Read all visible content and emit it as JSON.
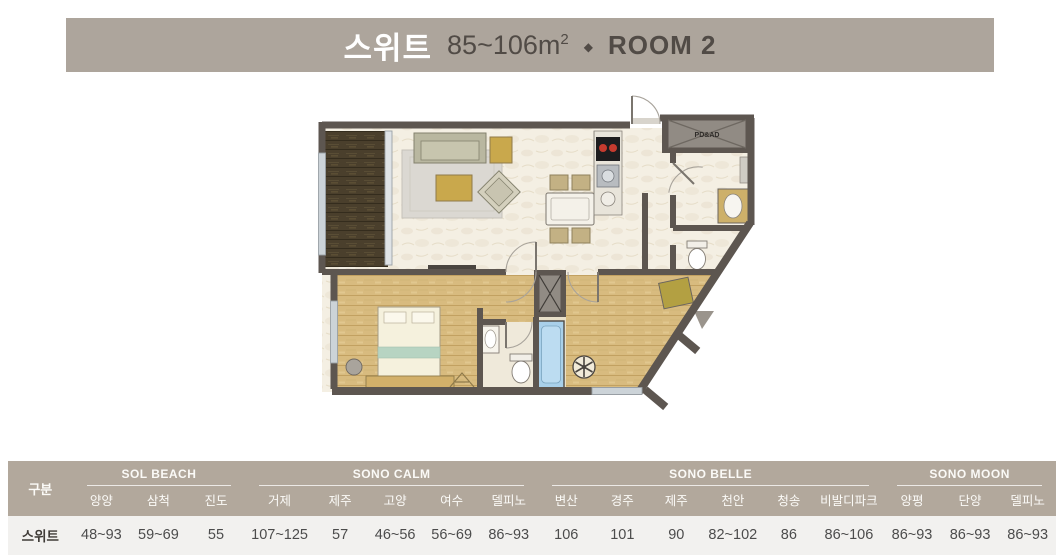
{
  "banner": {
    "title": "스위트",
    "size": "85~106m",
    "size_sup": "2",
    "separator": "◆",
    "room": "ROOM 2",
    "bg_color": "#ada59c",
    "title_color": "#ffffff",
    "text_color": "#514b46"
  },
  "floorplan": {
    "shaft_label": "PD&AD"
  },
  "table": {
    "col0_header": "구분",
    "row_label": "스위트",
    "header_bg": "#b2a89c",
    "header_text_color": "#fbfaf7",
    "row_bg": "#f2f1ef",
    "groups": [
      {
        "name": "SOL BEACH",
        "columns": [
          "양양",
          "삼척",
          "진도"
        ],
        "values": [
          "48~93",
          "59~69",
          "55"
        ]
      },
      {
        "name": "SONO CALM",
        "columns": [
          "거제",
          "제주",
          "고양",
          "여수",
          "델피노"
        ],
        "values": [
          "107~125",
          "57",
          "46~56",
          "56~69",
          "86~93"
        ]
      },
      {
        "name": "SONO BELLE",
        "columns": [
          "변산",
          "경주",
          "제주",
          "천안",
          "청송",
          "비발디파크"
        ],
        "values": [
          "106",
          "101",
          "90",
          "82~102",
          "86",
          "86~106"
        ]
      },
      {
        "name": "SONO MOON",
        "columns": [
          "양평",
          "단양",
          "델피노"
        ],
        "values": [
          "86~93",
          "86~93",
          "86~93"
        ]
      }
    ]
  }
}
